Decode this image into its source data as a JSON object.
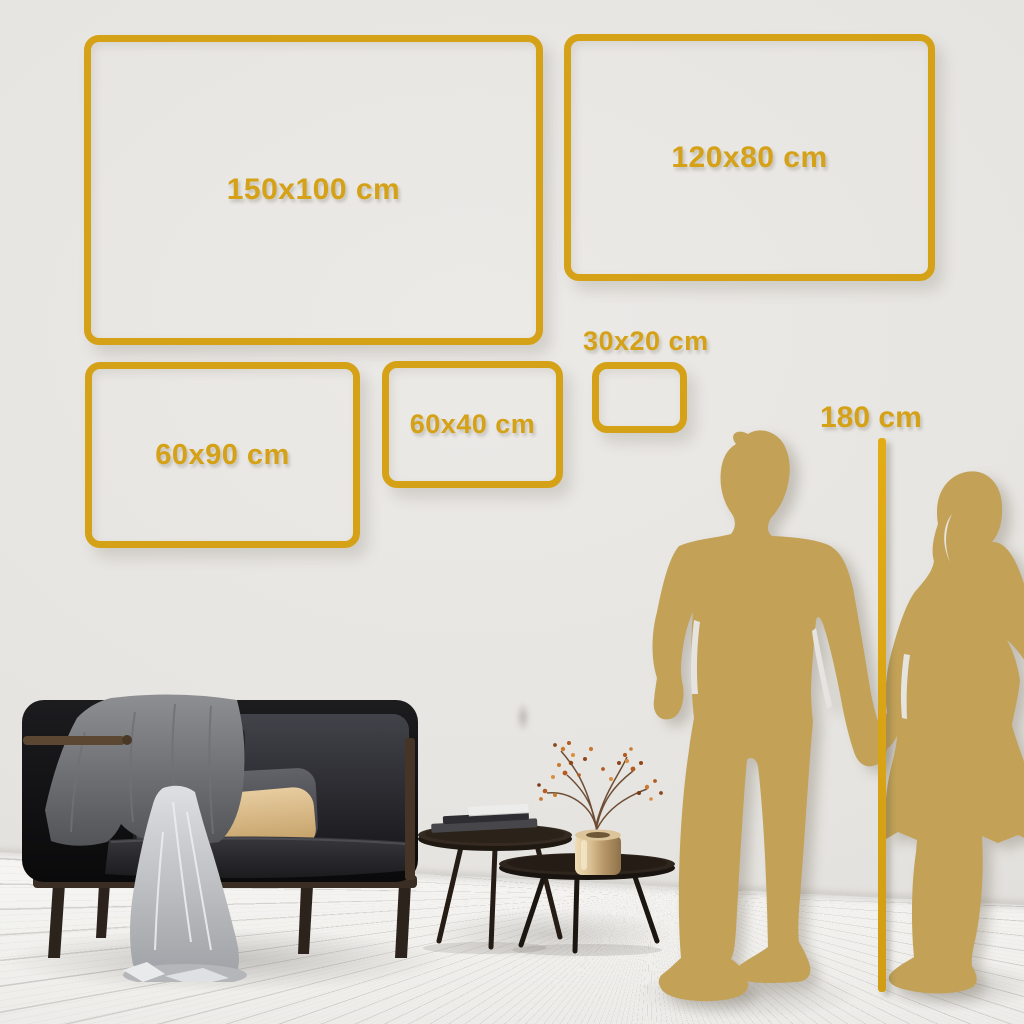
{
  "size_guide": {
    "frames": [
      {
        "id": "150x100",
        "label": "150x100 cm",
        "label_position": "inside"
      },
      {
        "id": "120x80",
        "label": "120x80 cm",
        "label_position": "inside"
      },
      {
        "id": "60x90",
        "label": "60x90 cm",
        "label_position": "inside"
      },
      {
        "id": "60x40",
        "label": "60x40 cm",
        "label_position": "inside"
      },
      {
        "id": "30x20",
        "label": "30x20 cm",
        "label_position": "above"
      }
    ],
    "height_reference": {
      "label": "180 cm"
    }
  },
  "colors": {
    "frame_gold": "#D5A117",
    "silhouette_gold": "#C3A258",
    "wall": "#E6E4E0",
    "floor": "#F4F3F1",
    "beige_pillow": "#D9BB8C"
  },
  "scene": {
    "furniture": [
      "dark-velvet-sofa",
      "gray-throw-blanket",
      "light-draped-sheet",
      "gray-pillow",
      "beige-pillow",
      "nesting-coffee-tables",
      "stack-of-books",
      "brass-vase",
      "dried-blossom-branch"
    ],
    "figures": [
      "man-silhouette",
      "woman-silhouette"
    ]
  }
}
